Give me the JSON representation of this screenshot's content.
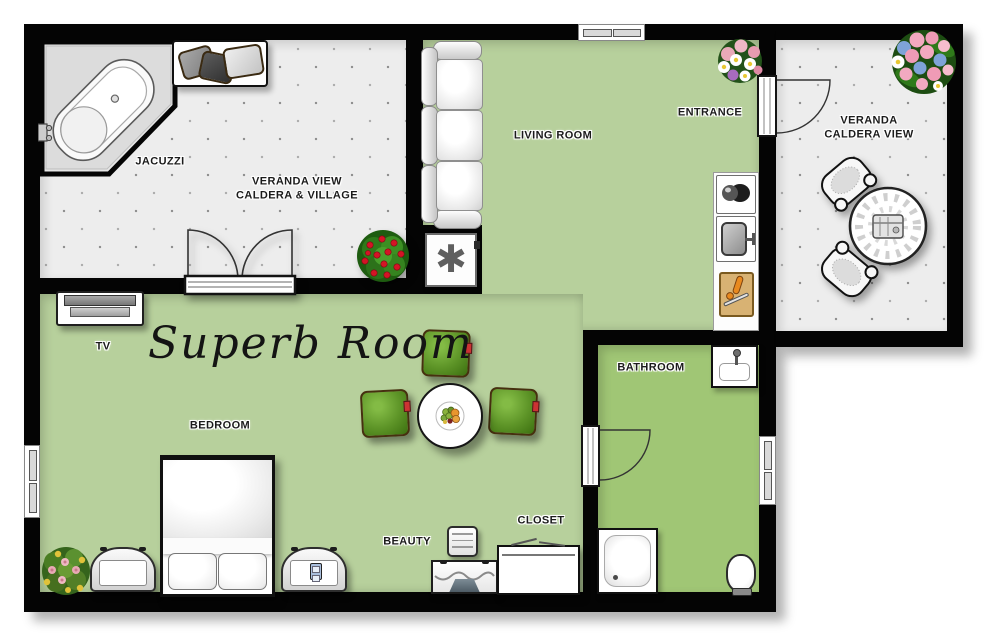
{
  "title": "Superb Room",
  "rooms": {
    "jacuzzi": {
      "label": "JACUZZI"
    },
    "veranda_view": {
      "line1": "VERANDA VIEW",
      "line2": "CALDERA & VILLAGE"
    },
    "living_room": {
      "label": "LIVING ROOM"
    },
    "entrance": {
      "label": "ENTRANCE"
    },
    "veranda_caldera": {
      "line1": "VERANDA",
      "line2": "CALDERA VIEW"
    },
    "bedroom": {
      "label": "BEDROOM"
    },
    "bathroom": {
      "label": "BATHROOM"
    },
    "beauty": {
      "label": "BEAUTY"
    },
    "closet": {
      "label": "CLOSET"
    },
    "tv": {
      "label": "TV"
    }
  },
  "symbols": {
    "ac_unit": "✱"
  },
  "colors": {
    "wall": "#040404",
    "room_green": "#b7d09c",
    "bathroom_green": "#a0c675",
    "veranda_floor": "#ededed",
    "cushion_green": "#5d9427",
    "background": "#ffffff"
  }
}
